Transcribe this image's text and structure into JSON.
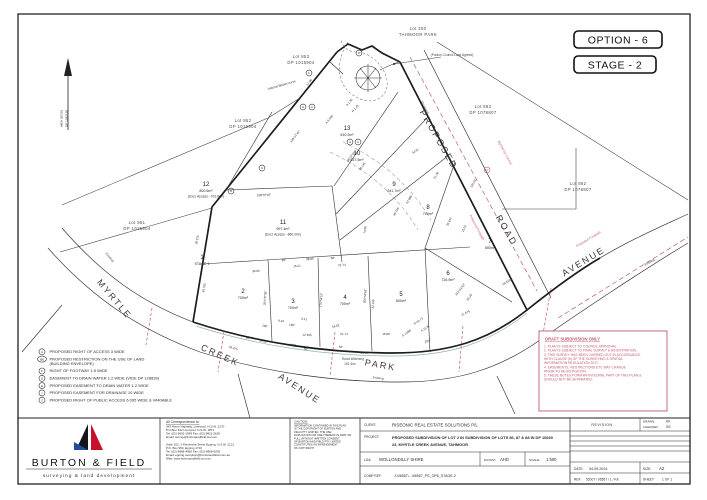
{
  "page": {
    "option": "OPTION - 6",
    "stage": "STAGE - 2"
  },
  "plan": {
    "north_line1": "MGA (2020)",
    "north_line2": "DP 1292192",
    "context_lots": [
      {
        "l1": "Lot 200",
        "l2": "TAHMOOR PARK",
        "x": 418,
        "y": 30
      },
      {
        "l1": "Lot 853",
        "l2": "DP 1015904",
        "x": 301,
        "y": 58
      },
      {
        "l1": "Lot 852",
        "l2": "DP 1015904",
        "x": 243,
        "y": 122
      },
      {
        "l1": "Lot 851",
        "l2": "DP 1015904",
        "x": 137,
        "y": 224
      },
      {
        "l1": "Lot 893",
        "l2": "DP 1078807",
        "x": 483,
        "y": 108
      },
      {
        "l1": "Lot 892",
        "l2": "DP 1078807",
        "x": 578,
        "y": 185
      }
    ],
    "lots": [
      {
        "n": "1",
        "a": "STAGE 1",
        "x": 202,
        "y": 259
      },
      {
        "n": "2",
        "a": "700m²",
        "x": 243,
        "y": 293
      },
      {
        "n": "3",
        "a": "700m²",
        "x": 293,
        "y": 303
      },
      {
        "n": "4",
        "a": "700m²",
        "x": 345,
        "y": 299
      },
      {
        "n": "5",
        "a": "800m²",
        "x": 401,
        "y": 296
      },
      {
        "n": "6",
        "a": "726.9m²",
        "x": 448,
        "y": 275
      },
      {
        "n": "7",
        "a": "800m²",
        "x": 490,
        "y": 243
      },
      {
        "n": "8",
        "a": "700m²",
        "x": 428,
        "y": 209
      },
      {
        "n": "9",
        "a": "841.7m²",
        "x": 394,
        "y": 186
      },
      {
        "n": "10",
        "a": "837.5m²",
        "x": 357,
        "y": 155
      },
      {
        "n": "11",
        "a": "997.4m²",
        "a2": "(Excl. Access - 860.2m²)",
        "x": 283,
        "y": 224
      },
      {
        "n": "12",
        "a": "800.6m²",
        "a2": "(Excl. Access - 701.9m²)",
        "x": 206,
        "y": 186
      },
      {
        "n": "13",
        "a": "810.2m²",
        "x": 347,
        "y": 130
      }
    ],
    "roads": [
      {
        "t": "MYRTLE",
        "x": 112,
        "y": 301,
        "r": 50
      },
      {
        "t": "CREEK",
        "x": 219,
        "y": 358,
        "r": 24
      },
      {
        "t": "AVENUE",
        "x": 298,
        "y": 391,
        "r": 33
      },
      {
        "t": "PARK",
        "x": 380,
        "y": 368,
        "r": 10
      },
      {
        "t": "PROPOSED",
        "x": 436,
        "y": 141,
        "r": 60
      },
      {
        "t": "ROAD",
        "x": 504,
        "y": 232,
        "r": 60
      },
      {
        "t": "AVENUE",
        "x": 585,
        "y": 264,
        "r": -31
      }
    ],
    "notes": [
      {
        "t": "Natural Watercourse",
        "x": 282,
        "y": 86,
        "r": -16
      },
      {
        "t": "(Portion Council Land Agreed)",
        "x": 452,
        "y": 56,
        "r": 0
      },
      {
        "t": "Road Widening",
        "x": 353,
        "y": 360,
        "r": 0
      },
      {
        "t": "192.4m²",
        "x": 350,
        "y": 365,
        "r": 0
      },
      {
        "t": "Existing",
        "x": 378,
        "y": 379,
        "r": 8
      },
      {
        "t": "Existing",
        "x": 109,
        "y": 258,
        "r": 50
      },
      {
        "t": "Existing",
        "x": 650,
        "y": 263,
        "r": -30
      },
      {
        "t": "Proposed",
        "x": 424,
        "y": 108,
        "r": 62
      }
    ],
    "red_notes": [
      {
        "t": "Agreed by Council",
        "x": 504,
        "y": 153,
        "r": 62
      },
      {
        "t": "Proposed Footpath",
        "x": 589,
        "y": 240,
        "r": -31
      },
      {
        "t": "Proposed Footpath",
        "x": 476,
        "y": 228,
        "r": 62
      }
    ],
    "marks": [
      {
        "l": "Z",
        "x": 359,
        "y": 53
      },
      {
        "l": "F",
        "x": 309,
        "y": 73
      },
      {
        "l": "G",
        "x": 303,
        "y": 107
      },
      {
        "l": "H",
        "x": 312,
        "y": 107
      },
      {
        "l": "G",
        "x": 262,
        "y": 168
      },
      {
        "l": "B",
        "x": 231,
        "y": 191
      },
      {
        "l": "G",
        "x": 350,
        "y": 142
      },
      {
        "l": "H",
        "x": 358,
        "y": 142
      },
      {
        "l": "Z",
        "x": 487,
        "y": 170,
        "red": true
      }
    ],
    "dims": [
      {
        "t": "36.115",
        "x": 198,
        "y": 240,
        "r": -81
      },
      {
        "t": "40.795",
        "x": 205,
        "y": 288,
        "r": -81
      },
      {
        "t": "17.96",
        "x": 310,
        "y": 83,
        "r": -52
      },
      {
        "t": "138°07'45\"",
        "x": 264,
        "y": 196,
        "r": -2
      },
      {
        "t": "89°",
        "x": 284,
        "y": 261,
        "r": -3
      },
      {
        "t": "38.95",
        "x": 310,
        "y": 260,
        "r": -3
      },
      {
        "t": "58°",
        "x": 333,
        "y": 259,
        "r": -3
      },
      {
        "t": "15.21",
        "x": 297,
        "y": 267,
        "r": -3
      },
      {
        "t": "21.74",
        "x": 342,
        "y": 266,
        "r": -2
      },
      {
        "t": "36.06",
        "x": 256,
        "y": 272,
        "r": -4
      },
      {
        "t": "35.475",
        "x": 233,
        "y": 349,
        "r": 18
      },
      {
        "t": "26.53",
        "x": 263,
        "y": 342,
        "r": 12
      },
      {
        "t": "16°",
        "x": 248,
        "y": 339,
        "r": 14
      },
      {
        "t": "269°",
        "x": 293,
        "y": 346,
        "r": 4
      },
      {
        "t": "12.335",
        "x": 307,
        "y": 336,
        "r": 2
      },
      {
        "t": "21.74",
        "x": 344,
        "y": 335,
        "r": 1
      },
      {
        "t": "15.89",
        "x": 386,
        "y": 335,
        "r": 0
      },
      {
        "t": "55.45",
        "x": 364,
        "y": 354,
        "r": 0
      },
      {
        "t": "58°",
        "x": 341,
        "y": 348,
        "r": 2
      },
      {
        "t": "58°",
        "x": 306,
        "y": 350,
        "r": 3
      },
      {
        "t": "8.94",
        "x": 281,
        "y": 322,
        "r": 8
      },
      {
        "t": "9.41",
        "x": 304,
        "y": 320,
        "r": 6
      },
      {
        "t": "180°",
        "x": 292,
        "y": 326,
        "r": 6
      },
      {
        "t": "280°",
        "x": 265,
        "y": 327,
        "r": 10
      },
      {
        "t": "16.52",
        "x": 336,
        "y": 327,
        "r": -14
      },
      {
        "t": "294°",
        "x": 428,
        "y": 342,
        "r": -14
      },
      {
        "t": "21.575",
        "x": 466,
        "y": 314,
        "r": -27
      },
      {
        "t": "19.315",
        "x": 507,
        "y": 283,
        "r": -31
      },
      {
        "t": "33.23",
        "x": 470,
        "y": 298,
        "r": -52
      },
      {
        "t": "314°01'50\"",
        "x": 461,
        "y": 290,
        "r": -52
      },
      {
        "t": "23.01",
        "x": 465,
        "y": 229,
        "r": -64
      },
      {
        "t": "35.615",
        "x": 450,
        "y": 222,
        "r": -64
      },
      {
        "t": "125.02",
        "x": 474,
        "y": 184,
        "r": -62
      },
      {
        "t": "57.885",
        "x": 410,
        "y": 200,
        "r": -60
      },
      {
        "t": "45.765",
        "x": 397,
        "y": 212,
        "r": -60
      },
      {
        "t": "48.145",
        "x": 363,
        "y": 167,
        "r": -53
      },
      {
        "t": "38°07'45\"",
        "x": 352,
        "y": 157,
        "r": -53
      },
      {
        "t": "44.97",
        "x": 416,
        "y": 152,
        "r": -30
      },
      {
        "t": "21.28",
        "x": 437,
        "y": 176,
        "r": -60
      },
      {
        "t": "74.55",
        "x": 366,
        "y": 230,
        "r": -82
      },
      {
        "t": "32.195",
        "x": 374,
        "y": 304,
        "r": -86
      },
      {
        "t": "359°56'55\"",
        "x": 366,
        "y": 296,
        "r": -86
      },
      {
        "t": "176°54'15\"",
        "x": 322,
        "y": 300,
        "r": -86
      },
      {
        "t": "204°37'35\"",
        "x": 266,
        "y": 298,
        "r": -86
      },
      {
        "t": "R 45.73",
        "x": 419,
        "y": 322,
        "r": -35
      },
      {
        "t": "A 11.87",
        "x": 426,
        "y": 329,
        "r": -35
      },
      {
        "t": "A 7.088",
        "x": 407,
        "y": 334,
        "r": -35
      },
      {
        "t": "A 1.36",
        "x": 350,
        "y": 103,
        "r": -50
      },
      {
        "t": "R 1.45",
        "x": 356,
        "y": 109,
        "r": -50
      },
      {
        "t": "A 6.095",
        "x": 330,
        "y": 120,
        "r": -50
      },
      {
        "t": "109°07'45\"",
        "x": 296,
        "y": 137,
        "r": -52
      }
    ],
    "legend": [
      {
        "sym": "A",
        "lines": [
          "PROPOSED RIGHT OF ACCESS 3 WIDE"
        ]
      },
      {
        "sym": "BE",
        "lines": [
          "PROPOSED RESTRICTION ON THE USE OF LAND",
          "(BUILDING ENVELOPE)"
        ]
      },
      {
        "sym": "F",
        "lines": [
          "RIGHT OF FOOTWAY 1.5 WIDE"
        ]
      },
      {
        "sym": "G",
        "lines": [
          "EASEMENT TO DRAIN WATER 1.2 WIDE (VIDE DP 128839)"
        ]
      },
      {
        "sym": "H",
        "lines": [
          "PROPOSED EASEMENT TO DRAIN WATER 1.2 WIDE"
        ]
      },
      {
        "sym": "I",
        "lines": [
          "PROPOSED EASEMENT FOR DRAINAGE 10 WIDE"
        ]
      },
      {
        "sym": "Z",
        "lines": [
          "PROPOSED RIGHT OF PUBLIC ACCESS 6.095 WIDE & VARIABLE"
        ]
      }
    ],
    "draft": {
      "title": "DRAFT SUBDIVISION ONLY",
      "lines": [
        "1. PLAN IS SUBJECT TO COUNCIL APPROVAL.",
        "2. PLAN IS SUBJECT TO FINAL SURVEY & REGISTRATION.",
        "3. THIS SURVEY HAS BEEN CARRIED OUT IN ACCORDANCE",
        "    WITH CLAUSE (5) OF THE SURVEYING & SPATIAL",
        "    INFORMATION REGULATION 2017.",
        "4. EASEMENTS, RESTRICTIONS ETC MAY CHANGE",
        "    PRIOR TO REGISTRATION.",
        "5. THESE NOTES FORM AN INTEGRAL PART OF THIS PLAN &",
        "    SHOULD NOT BE SEPARATED."
      ]
    }
  },
  "title_block": {
    "company": "BURTON & FIELD",
    "tagline": "surveying  &  land  development",
    "correspondence_heading": "All Correspondence to:",
    "address_lines": [
      "343 Hume Highway, Liverpool, N.S.W. 2170",
      "P.O.Box 342 Liverpool, N.S.W. 1871",
      "Tel: (02) 9602-1999    Fax: (02) 9821-2620",
      "Email: survey@burtonandfield.com.au",
      "",
      "Suite 202, 3 Pembroke Street Epping, N.S.W. 2121",
      "P.O. Box 950, Ep​ping 1710",
      "Tel: (02) 9868-4960    Fax: (02) 9868-6035",
      "Email: epping.reception@burtonandfield.com.au",
      "Web:  www.burtonandfield.com.au"
    ],
    "caution_heading": "CAUTION:",
    "caution_lines": [
      "INFORMATION CONTAINED IN THIS PLAN",
      "IS THE COPYRIGHT OF BURTON AND",
      "FIELD PTY LIMITED. THE USE,",
      "DUPLICATION OR USE THEREOF IN PART OR",
      "FULL WITHOUT WRITTEN CONSENT",
      "OF BURTON AND FIELD PTY LIMITED",
      "CONSTITUTES AN INFRINGEMENT",
      "OF COPYRIGHT"
    ],
    "client_label": "CLIENT:",
    "client": "RISEONIC REAL ESTATE SOLUTIONS P/L",
    "project_label": "PROJECT:",
    "project_line1": "PROPOSED SUBDIVISION OF LOT 2 IN SUBDIVISION OF LOTS 86, 87 & 88 IN DP 10669",
    "project_line2": "23, MYRTLE CREEK AVENUE, TAHMOOR",
    "lga_label": "LGA:",
    "lga": "WOLLONDILLY SHIRE",
    "datum_label": "DATUM:",
    "datum": "AHD",
    "scale_label": "SCALE:",
    "scale": "1:500",
    "compref_label": "COMP REF:",
    "compref": "J:\\06557\\...\\06557_PS_OP6_STAGE-2",
    "revision_label": "REVISION",
    "drawn_label": "DRAWN:",
    "drawn": "KK",
    "checked_label": "CHECKED:",
    "checked": "SS",
    "date_label": "DATE:",
    "date": "04.09.2024",
    "size_label": "SIZE:",
    "size": "A2",
    "ref_label": "REF:",
    "ref": "52007 / 06557 / 1 / KK",
    "sheet_label": "SHEET",
    "sheet_value": "1 OF 1"
  }
}
